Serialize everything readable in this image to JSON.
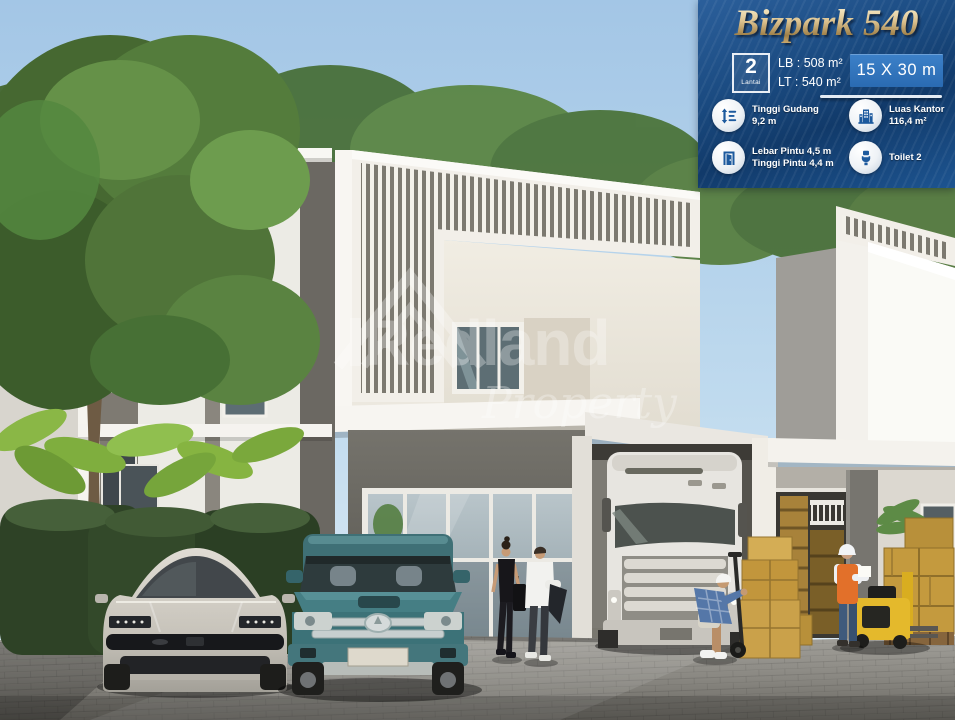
{
  "watermark": {
    "brand": "Redland",
    "subbrand": "Property"
  },
  "panel": {
    "title": "Bizpark 540",
    "floors": {
      "value": "2",
      "unit": "Lantai"
    },
    "building_area": "LB : 508 m²",
    "land_area": "LT : 540 m²",
    "dimensions": "15 X 30 m",
    "features": [
      {
        "icon": "warehouse-height-icon",
        "label": "Tinggi Gudang",
        "value": "9,2 m"
      },
      {
        "icon": "office-area-icon",
        "label": "Luas Kantor",
        "value": "116,4 m²"
      },
      {
        "icon": "door-size-icon",
        "label": "Lebar Pintu 4,5 m",
        "value": "Tinggi Pintu 4,4 m"
      },
      {
        "icon": "toilet-icon",
        "label": "Toilet 2",
        "value": ""
      }
    ],
    "colors": {
      "panel_top": "#2b5f9b",
      "panel_deep": "#113a6a",
      "accent_box": "#2e72ba",
      "title_gold": "#d9bf8d",
      "icon_blue": "#1d5a9e"
    }
  }
}
